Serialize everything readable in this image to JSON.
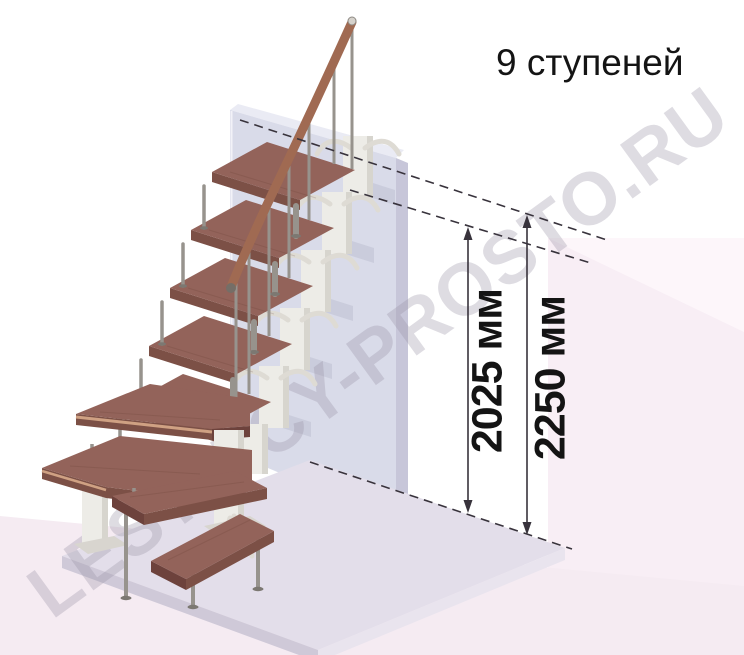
{
  "header": {
    "steps_label": "9 ступеней",
    "steps_count": 9
  },
  "dimensions": {
    "stair_height": {
      "label": "2025 мм",
      "value_mm": 2025
    },
    "total_height": {
      "label": "2250 мм",
      "value_mm": 2250
    }
  },
  "watermark": {
    "text": "LESTNICY-PROSTO.RU"
  },
  "colors": {
    "tread": "#93635a",
    "treadDark": "#7c5046",
    "treadSide": "#6d423c",
    "rail": "#a06a52",
    "metal": "#97938d",
    "metalDark": "#7c7872",
    "spine": "#edece7",
    "spineShade": "#d7d5ce",
    "wall": "#d9dbe9",
    "wallTop": "#eaebf4",
    "wallSide": "#c7c6d9",
    "floor1": "#f8eef5",
    "floor2": "#f5ebf2",
    "floor3": "#fdf6fa",
    "plat": "#e3deea",
    "platSide": "#cfc9d8",
    "platSide2": "#e9e4ee",
    "dim": "#38333c",
    "text": "#141414",
    "wm": "#9a94a6"
  }
}
